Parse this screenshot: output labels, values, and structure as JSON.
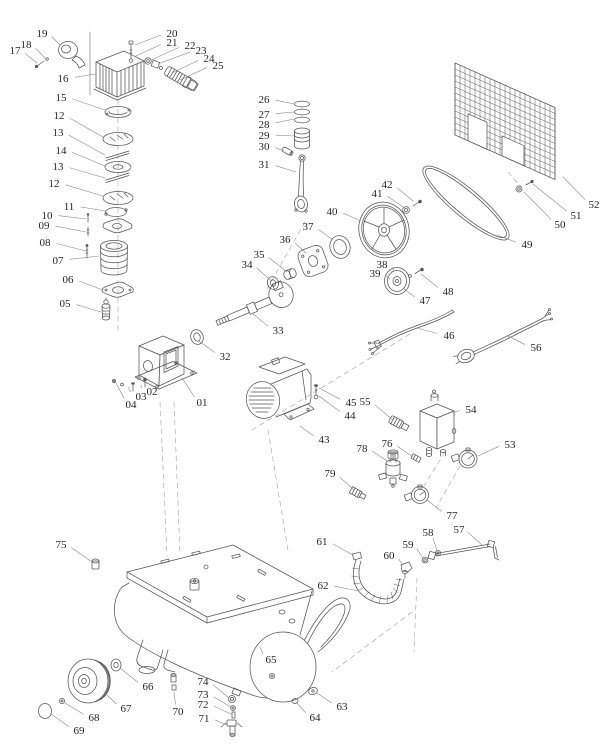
{
  "diagram": {
    "alt_text": "Belt-drive air compressor exploded parts diagram",
    "background_color": "#ffffff",
    "line_color": "#565656",
    "leader_color": "#8a8a8a",
    "label_color": "#262626",
    "labels": [
      {
        "text": "01",
        "x": 202,
        "y": 402,
        "tx": 182,
        "ty": 378
      },
      {
        "text": "02",
        "x": 152,
        "y": 391,
        "tx": 141,
        "ty": 385
      },
      {
        "text": "03",
        "x": 141,
        "y": 396,
        "tx": 128,
        "ty": 387
      },
      {
        "text": "04",
        "x": 131,
        "y": 404,
        "tx": 116,
        "ty": 383
      },
      {
        "text": "05",
        "x": 65,
        "y": 303,
        "tx": 101,
        "ty": 312
      },
      {
        "text": "06",
        "x": 68,
        "y": 279,
        "tx": 103,
        "ty": 290
      },
      {
        "text": "07",
        "x": 58,
        "y": 260,
        "tx": 99,
        "ty": 256
      },
      {
        "text": "08",
        "x": 45,
        "y": 242,
        "tx": 86,
        "ty": 251
      },
      {
        "text": "09",
        "x": 44,
        "y": 225,
        "tx": 86,
        "ty": 232
      },
      {
        "text": "10",
        "x": 47,
        "y": 215,
        "tx": 86,
        "ty": 219
      },
      {
        "text": "11",
        "x": 69,
        "y": 206,
        "tx": 105,
        "ty": 211
      },
      {
        "text": "12",
        "x": 59,
        "y": 115,
        "tx": 103,
        "ty": 137
      },
      {
        "text": "13",
        "x": 58,
        "y": 132,
        "tx": 105,
        "ty": 155
      },
      {
        "text": "14",
        "x": 61,
        "y": 150,
        "tx": 105,
        "ty": 166
      },
      {
        "text": "13",
        "x": 58,
        "y": 166,
        "tx": 105,
        "ty": 178
      },
      {
        "text": "12",
        "x": 54,
        "y": 183,
        "tx": 103,
        "ty": 196
      },
      {
        "text": "15",
        "x": 61,
        "y": 97,
        "tx": 105,
        "ty": 110
      },
      {
        "text": "16",
        "x": 63,
        "y": 78,
        "tx": 96,
        "ty": 74
      },
      {
        "text": "17",
        "x": 15,
        "y": 50,
        "tx": 37,
        "ty": 63
      },
      {
        "text": "18",
        "x": 26,
        "y": 44,
        "tx": 46,
        "ty": 59
      },
      {
        "text": "19",
        "x": 42,
        "y": 33,
        "tx": 60,
        "ty": 45
      },
      {
        "text": "20",
        "x": 172,
        "y": 33,
        "tx": 135,
        "ty": 45
      },
      {
        "text": "21",
        "x": 172,
        "y": 42,
        "tx": 136,
        "ty": 56
      },
      {
        "text": "22",
        "x": 190,
        "y": 45,
        "tx": 151,
        "ty": 60
      },
      {
        "text": "23",
        "x": 201,
        "y": 50,
        "tx": 158,
        "ty": 64
      },
      {
        "text": "24",
        "x": 209,
        "y": 58,
        "tx": 172,
        "ty": 73
      },
      {
        "text": "25",
        "x": 218,
        "y": 65,
        "tx": 180,
        "ty": 80
      },
      {
        "text": "26",
        "x": 264,
        "y": 99,
        "tx": 294,
        "ty": 104
      },
      {
        "text": "27",
        "x": 264,
        "y": 114,
        "tx": 294,
        "ty": 112
      },
      {
        "text": "28",
        "x": 264,
        "y": 124,
        "tx": 294,
        "ty": 119
      },
      {
        "text": "29",
        "x": 264,
        "y": 135,
        "tx": 294,
        "ty": 136
      },
      {
        "text": "30",
        "x": 264,
        "y": 146,
        "tx": 284,
        "ty": 151
      },
      {
        "text": "31",
        "x": 264,
        "y": 164,
        "tx": 296,
        "ty": 172
      },
      {
        "text": "32",
        "x": 225,
        "y": 356,
        "tx": 199,
        "ty": 341
      },
      {
        "text": "33",
        "x": 278,
        "y": 330,
        "tx": 252,
        "ty": 313
      },
      {
        "text": "34",
        "x": 247,
        "y": 264,
        "tx": 270,
        "ty": 280
      },
      {
        "text": "35",
        "x": 259,
        "y": 254,
        "tx": 287,
        "ty": 272
      },
      {
        "text": "36",
        "x": 285,
        "y": 239,
        "tx": 306,
        "ty": 253
      },
      {
        "text": "37",
        "x": 308,
        "y": 226,
        "tx": 333,
        "ty": 240
      },
      {
        "text": "38",
        "x": 382,
        "y": 264,
        "tx": 394,
        "ty": 271
      },
      {
        "text": "39",
        "x": 375,
        "y": 273,
        "tx": 390,
        "ty": 279
      },
      {
        "text": "40",
        "x": 332,
        "y": 211,
        "tx": 361,
        "ty": 221
      },
      {
        "text": "41",
        "x": 377,
        "y": 193,
        "tx": 403,
        "ty": 207
      },
      {
        "text": "42",
        "x": 387,
        "y": 184,
        "tx": 413,
        "ty": 201
      },
      {
        "text": "43",
        "x": 324,
        "y": 439,
        "tx": 300,
        "ty": 426
      },
      {
        "text": "44",
        "x": 350,
        "y": 415,
        "tx": 319,
        "ty": 396
      },
      {
        "text": "45",
        "x": 351,
        "y": 402,
        "tx": 319,
        "ty": 388
      },
      {
        "text": "46",
        "x": 449,
        "y": 335,
        "tx": 417,
        "ty": 328
      },
      {
        "text": "47",
        "x": 425,
        "y": 300,
        "tx": 404,
        "ty": 289
      },
      {
        "text": "48",
        "x": 448,
        "y": 291,
        "tx": 421,
        "ty": 274
      },
      {
        "text": "49",
        "x": 527,
        "y": 244,
        "tx": 497,
        "ty": 235
      },
      {
        "text": "50",
        "x": 560,
        "y": 224,
        "tx": 524,
        "ty": 192
      },
      {
        "text": "51",
        "x": 576,
        "y": 215,
        "tx": 533,
        "ty": 184
      },
      {
        "text": "52",
        "x": 594,
        "y": 204,
        "tx": 563,
        "ty": 177
      },
      {
        "text": "53",
        "x": 510,
        "y": 444,
        "tx": 478,
        "ty": 456
      },
      {
        "text": "54",
        "x": 471,
        "y": 409,
        "tx": 453,
        "ty": 413
      },
      {
        "text": "55",
        "x": 365,
        "y": 401,
        "tx": 393,
        "ty": 420
      },
      {
        "text": "56",
        "x": 536,
        "y": 347,
        "tx": 508,
        "ty": 336
      },
      {
        "text": "57",
        "x": 459,
        "y": 529,
        "tx": 483,
        "ty": 546
      },
      {
        "text": "58",
        "x": 428,
        "y": 532,
        "tx": 437,
        "ty": 551
      },
      {
        "text": "59",
        "x": 408,
        "y": 544,
        "tx": 423,
        "ty": 558
      },
      {
        "text": "60",
        "x": 389,
        "y": 555,
        "tx": 403,
        "ty": 565
      },
      {
        "text": "61",
        "x": 322,
        "y": 541,
        "tx": 353,
        "ty": 555
      },
      {
        "text": "62",
        "x": 323,
        "y": 585,
        "tx": 358,
        "ty": 591
      },
      {
        "text": "63",
        "x": 342,
        "y": 706,
        "tx": 317,
        "ty": 693
      },
      {
        "text": "64",
        "x": 315,
        "y": 717,
        "tx": 297,
        "ty": 703
      },
      {
        "text": "65",
        "x": 271,
        "y": 659,
        "tx": 260,
        "ty": 647
      },
      {
        "text": "66",
        "x": 148,
        "y": 686,
        "tx": 120,
        "ty": 668
      },
      {
        "text": "67",
        "x": 126,
        "y": 708,
        "tx": 104,
        "ty": 692
      },
      {
        "text": "68",
        "x": 94,
        "y": 717,
        "tx": 65,
        "ty": 703
      },
      {
        "text": "69",
        "x": 79,
        "y": 730,
        "tx": 51,
        "ty": 714
      },
      {
        "text": "70",
        "x": 178,
        "y": 711,
        "tx": 174,
        "ty": 692
      },
      {
        "text": "71",
        "x": 204,
        "y": 718,
        "tx": 227,
        "ty": 725
      },
      {
        "text": "72",
        "x": 203,
        "y": 704,
        "tx": 231,
        "ty": 714
      },
      {
        "text": "73",
        "x": 203,
        "y": 694,
        "tx": 231,
        "ty": 707
      },
      {
        "text": "74",
        "x": 203,
        "y": 681,
        "tx": 229,
        "ty": 698
      },
      {
        "text": "75",
        "x": 61,
        "y": 544,
        "tx": 92,
        "ty": 562
      },
      {
        "text": "76",
        "x": 387,
        "y": 443,
        "tx": 413,
        "ty": 457
      },
      {
        "text": "77",
        "x": 452,
        "y": 515,
        "tx": 427,
        "ty": 500
      },
      {
        "text": "78",
        "x": 362,
        "y": 448,
        "tx": 387,
        "ty": 461
      },
      {
        "text": "79",
        "x": 330,
        "y": 473,
        "tx": 354,
        "ty": 490
      }
    ]
  }
}
